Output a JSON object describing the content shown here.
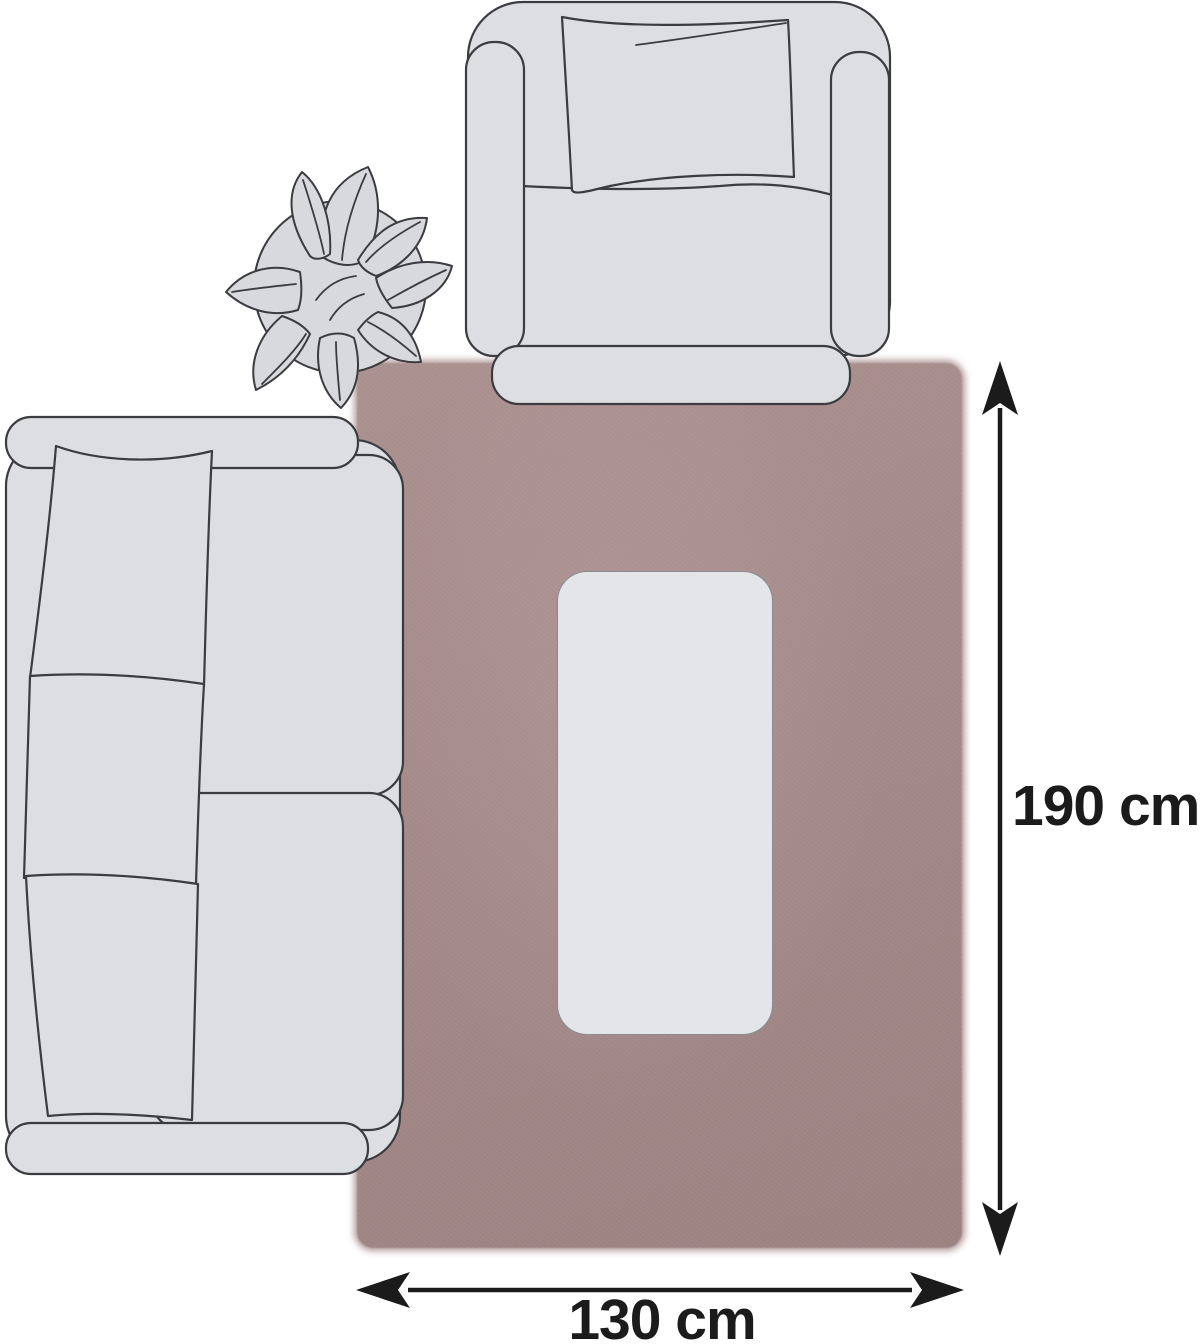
{
  "diagram": {
    "kind": "rug-size-illustration",
    "dimensions": {
      "height_label": "190 cm",
      "width_label": "130 cm"
    },
    "colors": {
      "background": "#ffffff",
      "rug": "#a38888",
      "furniture_fill": "#dcdee1",
      "plant_fill": "#d7d9dc",
      "table_fill": "#e3e5e8",
      "outline": "#3b3b40",
      "arrow_and_text": "#1b1b1b"
    },
    "objects": [
      "rug",
      "coffee-table",
      "armchair-top-view",
      "sofa-top-view",
      "plant-top-view",
      "height-arrow",
      "width-arrow"
    ]
  }
}
